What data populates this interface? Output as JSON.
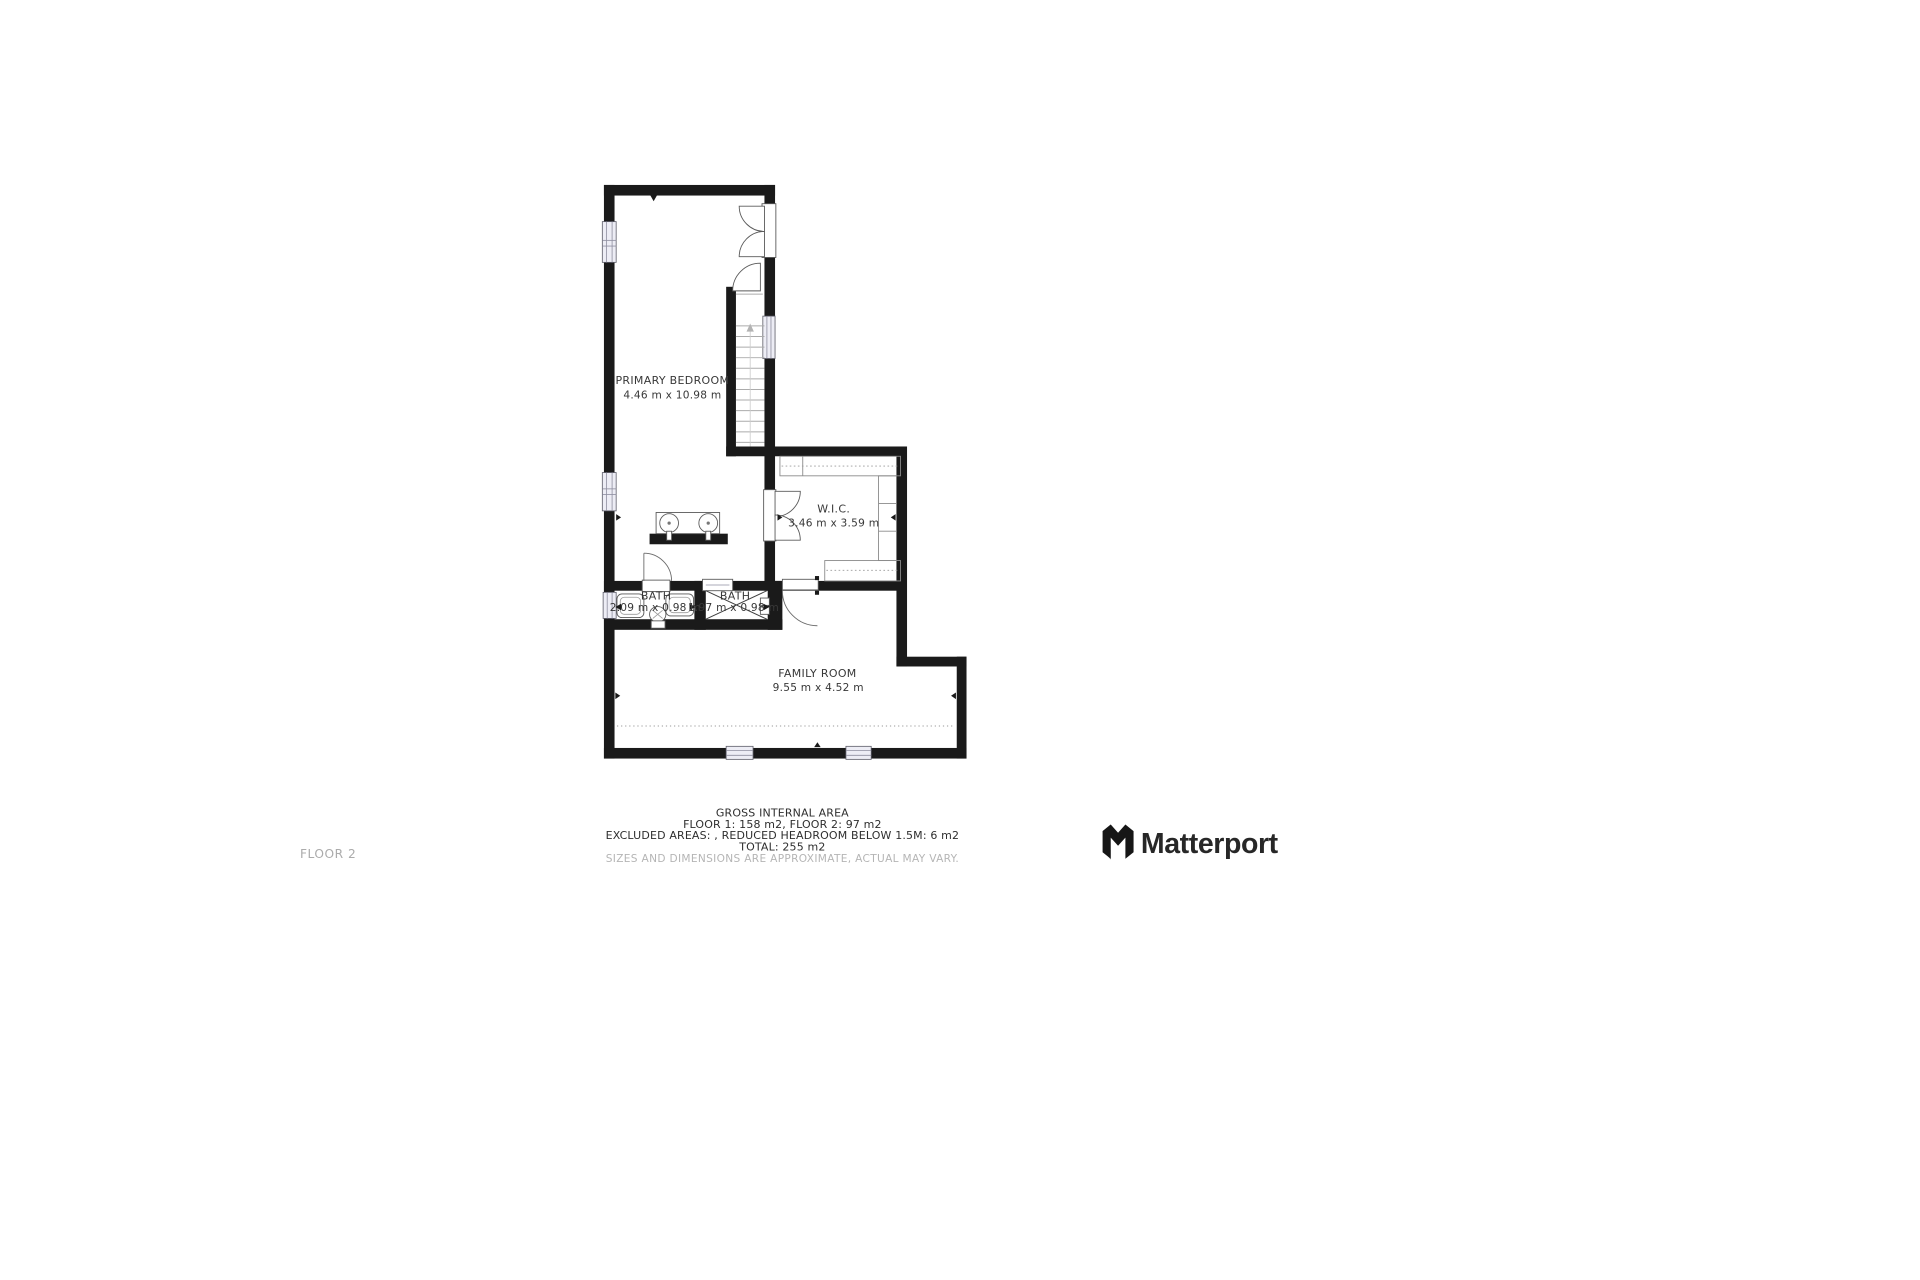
{
  "floor_label": "FLOOR 2",
  "brand": {
    "name": "Matterport"
  },
  "rooms": {
    "primary_bedroom": {
      "name": "PRIMARY BEDROOM",
      "dims": "4.46 m x 10.98 m"
    },
    "wic": {
      "name": "W.I.C.",
      "dims": "3.46 m x 3.59 m"
    },
    "bath_1": {
      "name": "BATH",
      "dims": "2.09 m x 0.98 m"
    },
    "bath_2": {
      "name": "BATH",
      "dims": "1.97 m x 0.98 m"
    },
    "family_room": {
      "name": "FAMILY ROOM",
      "dims": "9.55 m x 4.52 m"
    }
  },
  "footer": {
    "title": "GROSS INTERNAL AREA",
    "line1": "FLOOR 1: 158 m2, FLOOR 2: 97 m2",
    "line2": "EXCLUDED AREAS: , REDUCED HEADROOM BELOW 1.5M: 6 m2",
    "line3": "TOTAL: 255 m2",
    "disclaimer": "SIZES AND DIMENSIONS ARE APPROXIMATE, ACTUAL MAY VARY."
  },
  "colors": {
    "wall": "#1a1a1a",
    "label": "#383838",
    "muted": "#ababab",
    "brand": "#272727"
  }
}
